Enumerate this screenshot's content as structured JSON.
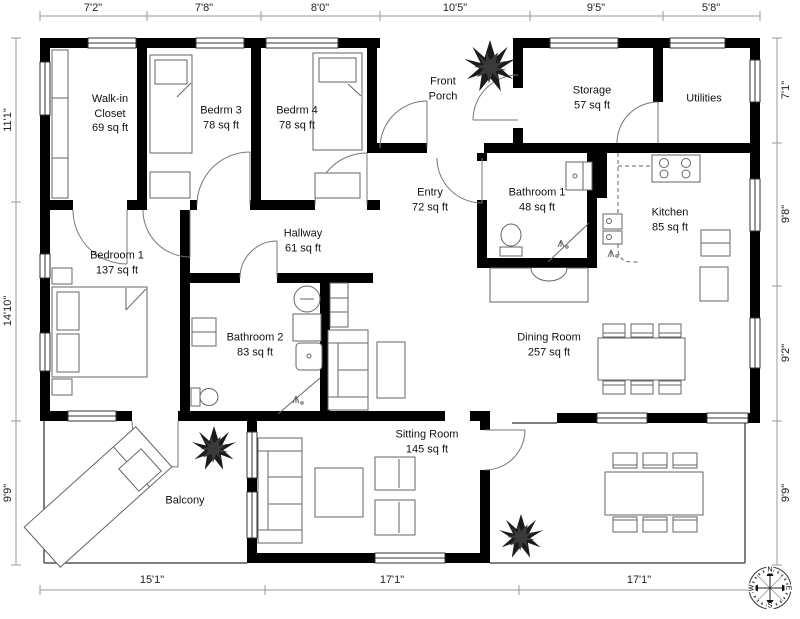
{
  "rooms": [
    {
      "name": "Walk-in Closet",
      "area": "69 sq ft"
    },
    {
      "name": "Bedrm 3",
      "area": "78 sq ft"
    },
    {
      "name": "Bedrm 4",
      "area": "78 sq ft"
    },
    {
      "name": "Front Porch",
      "area": ""
    },
    {
      "name": "Storage",
      "area": "57 sq ft"
    },
    {
      "name": "Utilities",
      "area": ""
    },
    {
      "name": "Entry",
      "area": "72 sq ft"
    },
    {
      "name": "Bathroom 1",
      "area": "48 sq ft"
    },
    {
      "name": "Kitchen",
      "area": "85 sq ft"
    },
    {
      "name": "Hallway",
      "area": "61 sq ft"
    },
    {
      "name": "Bedroom 1",
      "area": "137 sq ft"
    },
    {
      "name": "Bathroom 2",
      "area": "83 sq ft"
    },
    {
      "name": "Dining Room",
      "area": "257 sq ft"
    },
    {
      "name": "Sitting Room",
      "area": "145 sq ft"
    },
    {
      "name": "Balcony",
      "area": ""
    }
  ],
  "dimensions": {
    "top": [
      "7'2\"",
      "7'8\"",
      "8'0\"",
      "10'5\"",
      "9'5\"",
      "5'8\""
    ],
    "bottom": [
      "15'1\"",
      "17'1\"",
      "17'1\""
    ],
    "left": [
      "11'1\"",
      "14'10\"",
      "9'9\""
    ],
    "right": [
      "7'1\"",
      "9'8\"",
      "9'2\"",
      "9'9\""
    ]
  },
  "compass": {
    "n": "N",
    "e": "E",
    "s": "S",
    "w": "W"
  }
}
